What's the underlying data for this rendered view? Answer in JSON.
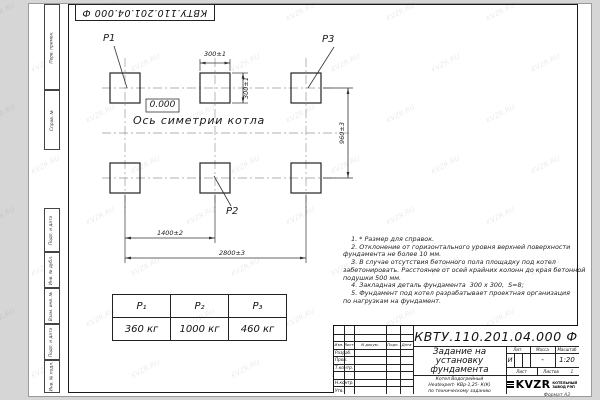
{
  "watermark": "KVZR.RU",
  "stamp_top": "КВТУ.110.201.04.000  Ф",
  "margin": {
    "labels": [
      "Перв. примен.",
      "Справ. №",
      "Подп. и дата",
      "Инв. № дубл.",
      "Взам. инв. №",
      "Подп. и дата",
      "Инв. № подл."
    ]
  },
  "plan": {
    "labels": {
      "p1": "P1",
      "p2": "P2",
      "p3": "P3"
    },
    "elevation": "0.000",
    "axis_caption": "Ось симетрии котла",
    "dims": {
      "pad_width": "300±1",
      "pad_height": "300±1",
      "row_spacing": "960±3",
      "col_spacing": "1400±2",
      "total_span": "2800±3"
    }
  },
  "weights_table": {
    "headers": [
      "P₁",
      "P₂",
      "P₃"
    ],
    "values": [
      "360 кг",
      "1000 кг",
      "460 кг"
    ]
  },
  "notes": {
    "lines": [
      "    1. * Размер для справок.",
      "    2. Отклонение от горизонтального уровня верхней поверхности",
      "фундамента не более 10 мм.",
      "    3. В случае отсутствия бетонного пола площадку под котел",
      "забетонировать. Расстояние от осей крайних колонн до края бетонной",
      "подушки 500 мм.",
      "    4. Закладная деталь фундамента  300 x 300,  S=8;",
      "    5. Фундамент под котел разрабатывает проектная организация",
      "по нагрузкам на фундамент."
    ]
  },
  "title_block": {
    "doc_number": "КВТУ.110.201.04.000  Ф",
    "title_lines": [
      "Задание на",
      "установку",
      "фундамента"
    ],
    "subtitle_lines": [
      "Котел Водогрейный",
      "Heatexpert- КВр-1,25- К(К)",
      "по техническому заданию"
    ],
    "rev_header": [
      "Изм.",
      "Лист",
      "N докум.",
      "Подп.",
      "Дата"
    ],
    "roles": [
      "Разраб.",
      "Пров.",
      "Т.контр.",
      "",
      "Н.контр.",
      "Утв."
    ],
    "lit_label": "Лит.",
    "mass_label": "Масса",
    "scale_label": "Масштаб",
    "lit_value": "И",
    "mass_value": "-",
    "scale_value": "1:20",
    "sheet_label": "Лист",
    "sheets_label": "Листов",
    "sheets_value": "1",
    "company_logo": "KVZR",
    "company_name": "КОТЕЛЬНЫЙ ЗАВОД РЭП",
    "format_note": "Формат А3"
  }
}
